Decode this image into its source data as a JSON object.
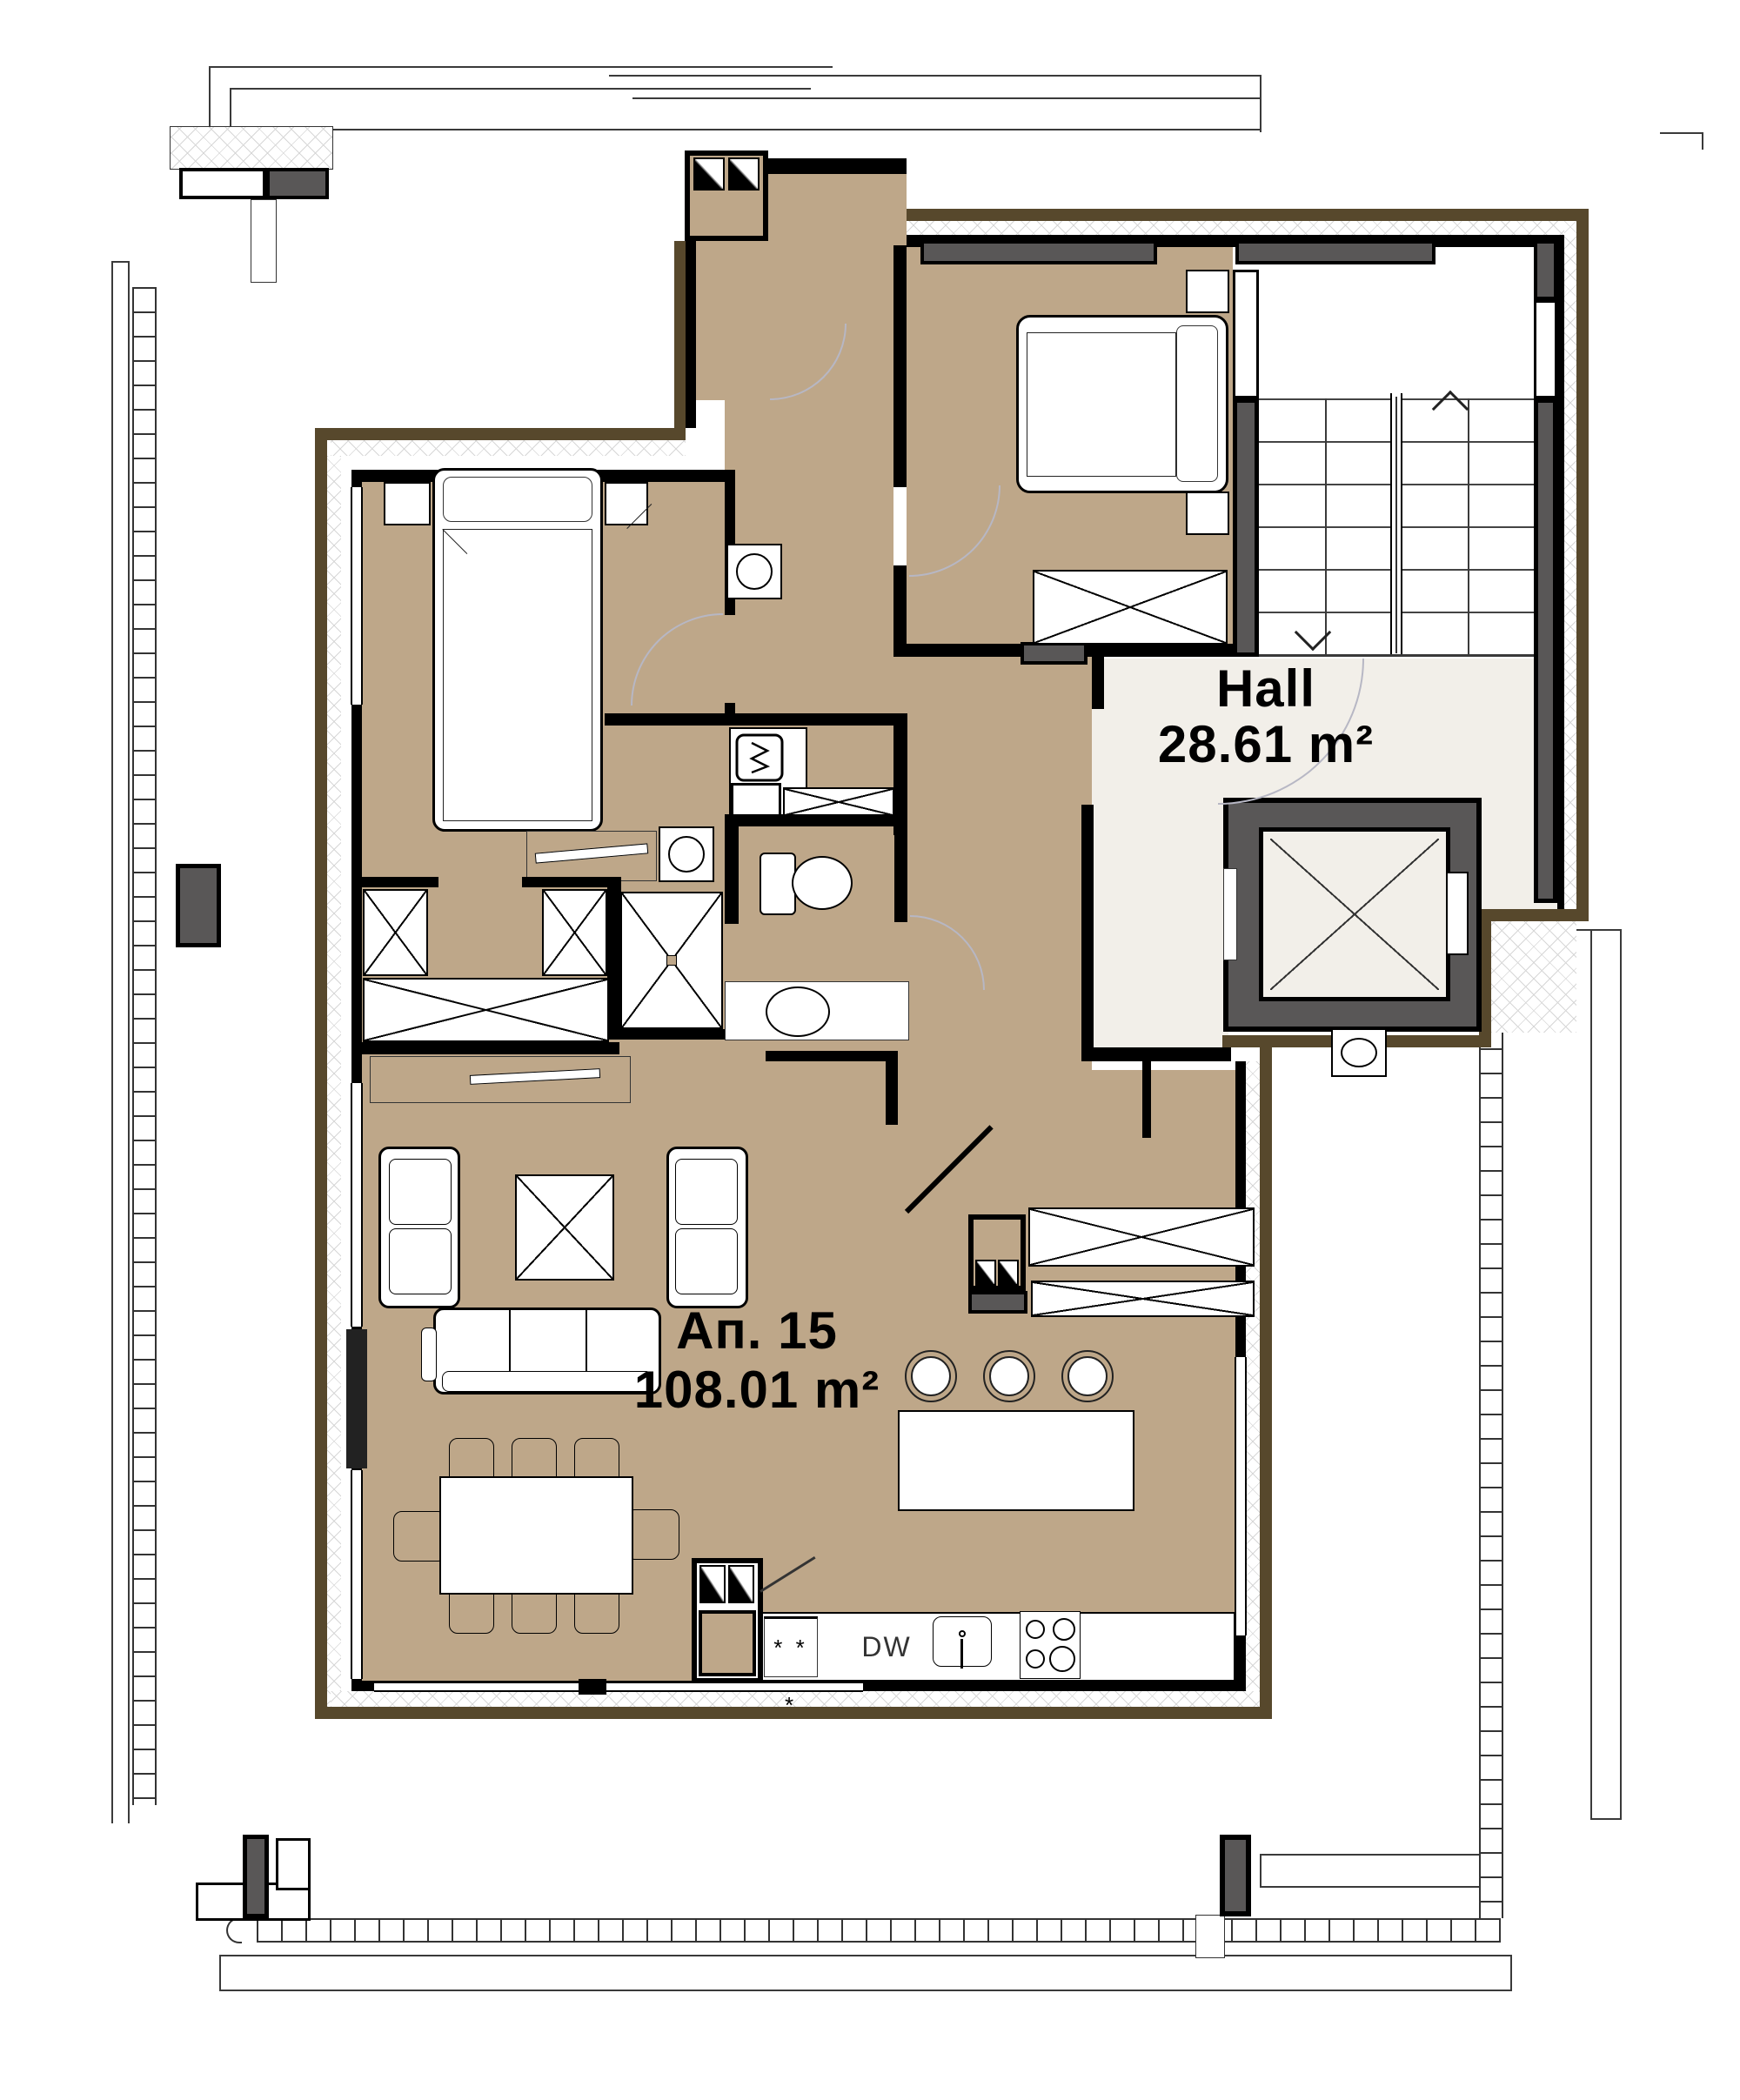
{
  "plan": {
    "type": "architectural-floor-plan",
    "floor_color": "#BEA789",
    "hall_color": "#F2EFE9",
    "wall_color": "#000000",
    "concrete_color": "#595757",
    "perimeter_band_color": "#57482C",
    "door_arc_color": "#B7B7C4"
  },
  "rooms": [
    {
      "id": "hall",
      "name": "Hall",
      "area": "28.61 m²"
    },
    {
      "id": "apartment-15",
      "name": "Ап. 15",
      "area": "108.01 m²"
    }
  ],
  "labels": {
    "hall_name": "Hall",
    "hall_area": "28.61 m²",
    "apartment_name": "Ап. 15",
    "apartment_area": "108.01 m²",
    "dishwasher": "DW",
    "freezer": "* * *"
  },
  "icons": [
    "staircase",
    "stair-up-arrow",
    "stair-down-arrow",
    "elevator",
    "double-bed",
    "nightstand",
    "wardrobe",
    "sofa",
    "armchair",
    "coffee-table",
    "dining-table",
    "dining-chair",
    "kitchen-island",
    "bar-stool",
    "kitchen-sink",
    "stove",
    "dishwasher",
    "refrigerator",
    "washing-machine",
    "shower",
    "toilet",
    "washbasin",
    "vent-shaft",
    "door-swing",
    "balcony-railing",
    "terrace-column",
    "window"
  ]
}
